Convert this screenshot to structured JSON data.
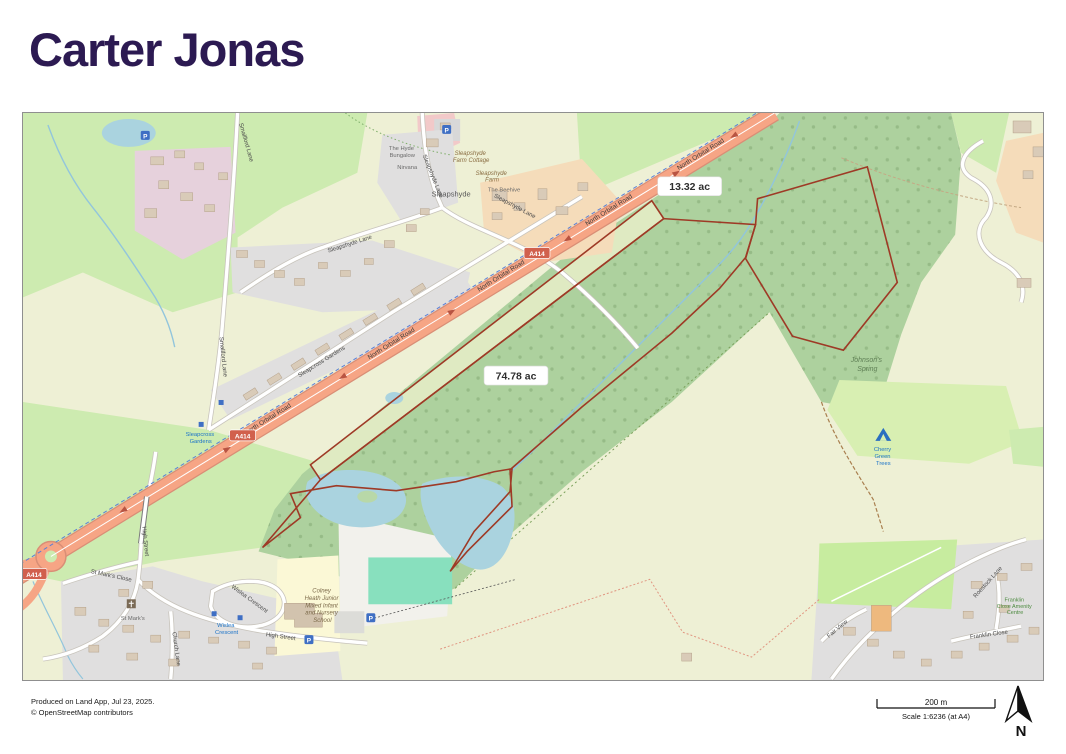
{
  "header": {
    "logo_text": "Carter Jonas"
  },
  "map": {
    "area_labels": [
      {
        "text": "13.32 ac"
      },
      {
        "text": "74.78 ac"
      }
    ],
    "roads": {
      "north_orbital": "North Orbital Road",
      "a414": "A414",
      "smallford_lane": "Smallford Lane",
      "sleapshyde_lane": "Sleapshyde Lane",
      "sleapcross_gardens": "Sleapcross Gardens",
      "high_street": "High Street",
      "st_marks_close": "St Mark's Close",
      "wislea_crescent": "Wislea Crescent",
      "church_lane": "Church Lane",
      "roestock_lane": "Roestock Lane",
      "franklin_close": "Franklin Close",
      "fair_view": "Fair View"
    },
    "places": {
      "sleapshyde": "Sleapshyde",
      "sleapshyde_farm_cottage_lines": [
        "Sleapshyde",
        "Farm Cottage"
      ],
      "sleapshyde_farm_lines": [
        "Sleapshyde",
        "Farm"
      ],
      "the_beehive": "The Beehive",
      "hyde_bungalow_lines": [
        "The Hyde",
        "Bungalow"
      ],
      "nirvana": "Nirvana",
      "johnsons_spring_lines": [
        "Johnson's",
        "Spring"
      ],
      "cherry_green_lines": [
        "Cherry",
        "Green",
        "Trees"
      ],
      "school_lines": [
        "Colney",
        "Heath Junior",
        "Mixed Infant",
        "and Nursery",
        "School"
      ],
      "st_marks": "St Mark's",
      "wislea_stop_lines": [
        "Wislea",
        "Crescent"
      ],
      "sleapcross_stop_lines": [
        "Sleapcross",
        "Gardens"
      ],
      "franklin_amenity_lines": [
        "Franklin",
        "Close Amenity",
        "Centre"
      ]
    },
    "icons": {
      "parking_letter": "P"
    },
    "colors": {
      "logo_purple": "#2c1a52",
      "parcel_boundary": "#9e3a26",
      "trunk_road": "#f6a585",
      "water": "#aad3df",
      "woodland": "#add19e",
      "grass": "#cdebb0",
      "farmland": "#eef0d5",
      "residential": "#e0dfdf"
    }
  },
  "footer": {
    "produced_text": "Produced on Land App, Jul 23, 2025.",
    "attribution_text": "© OpenStreetMap contributors"
  },
  "scalebar": {
    "distance_label": "200 m",
    "scale_label": "Scale 1:6236 (at A4)",
    "north_label": "N"
  }
}
